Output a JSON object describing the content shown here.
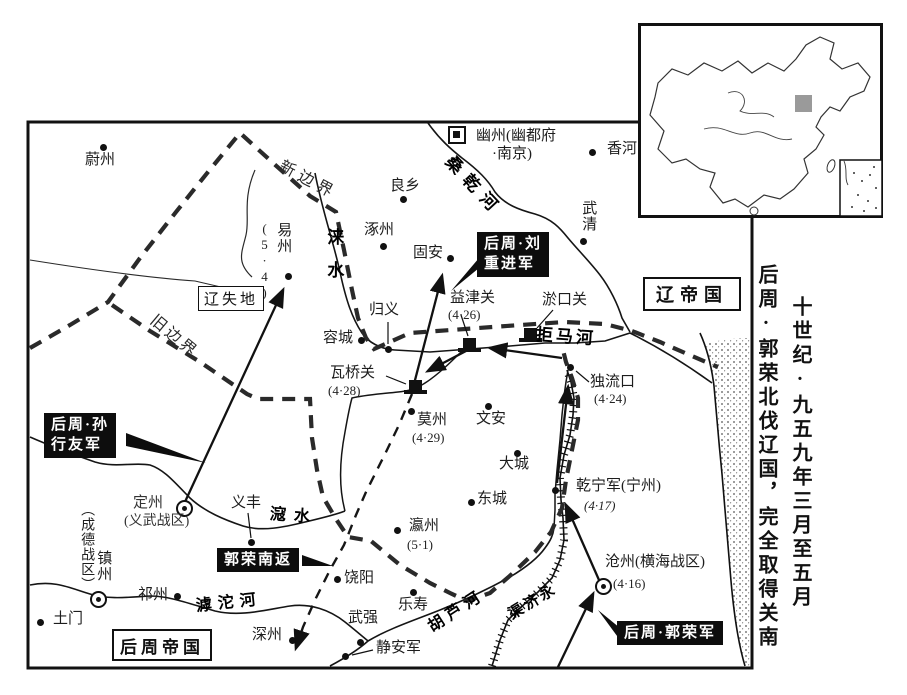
{
  "side_titles": {
    "col1": "十世纪·九五九年三月至五月",
    "col2": "后周·郭荣北伐辽国，完全取得关南"
  },
  "regions": {
    "liao_empire": "辽帝国",
    "liao_lost_land": "辽失地",
    "zhou_empire": "后周帝国"
  },
  "boundaries": {
    "new_border": "新边界",
    "old_border": "旧边界"
  },
  "rivers": {
    "sanggan": "桑乾河",
    "lai": "涞水",
    "juma": "拒马河",
    "kou": "滱水",
    "hutuo": "滹沱河",
    "hulu": "胡芦河",
    "yongji_name": "永济渠",
    "yongji_display": "渠济永"
  },
  "army_labels": {
    "liu_line1": "后周·刘",
    "liu_line2": "重进军",
    "sun_line1": "后周·孙",
    "sun_line2": "行友军",
    "guo_return": "郭荣南返",
    "guo_main": "后周·郭荣军"
  },
  "cities": [
    {
      "name": "蔚州"
    },
    {
      "name": "良乡"
    },
    {
      "name": "涿州"
    },
    {
      "name": "固安"
    },
    {
      "name": "香河"
    },
    {
      "name": "武清"
    },
    {
      "name": "幽州(幽都府",
      "name2": "·南京)"
    },
    {
      "name": "易州",
      "date": "(5·4)"
    },
    {
      "name": "归义"
    },
    {
      "name": "容城"
    },
    {
      "name": "益津关",
      "date": "(4·26)"
    },
    {
      "name": "淤口关"
    },
    {
      "name": "独流口",
      "date": "(4·24)"
    },
    {
      "name": "瓦桥关",
      "date": "(4·28)"
    },
    {
      "name": "莫州",
      "date": "(4·29)"
    },
    {
      "name": "文安"
    },
    {
      "name": "大城"
    },
    {
      "name": "东城"
    },
    {
      "name": "瀛州",
      "date": "(5·1)"
    },
    {
      "name": "乾宁军(宁州)",
      "date": "(4·17)"
    },
    {
      "name": "沧州(横海战区)",
      "date": "(4·16)"
    },
    {
      "name": "定州",
      "sub": "(义武战区)"
    },
    {
      "name": "义丰"
    },
    {
      "name": "镇州",
      "sub": "（成德战区）"
    },
    {
      "name": "祁州"
    },
    {
      "name": "饶阳"
    },
    {
      "name": "乐寿"
    },
    {
      "name": "武强"
    },
    {
      "name": "静安军"
    },
    {
      "name": "深州"
    },
    {
      "name": "土门"
    }
  ]
}
